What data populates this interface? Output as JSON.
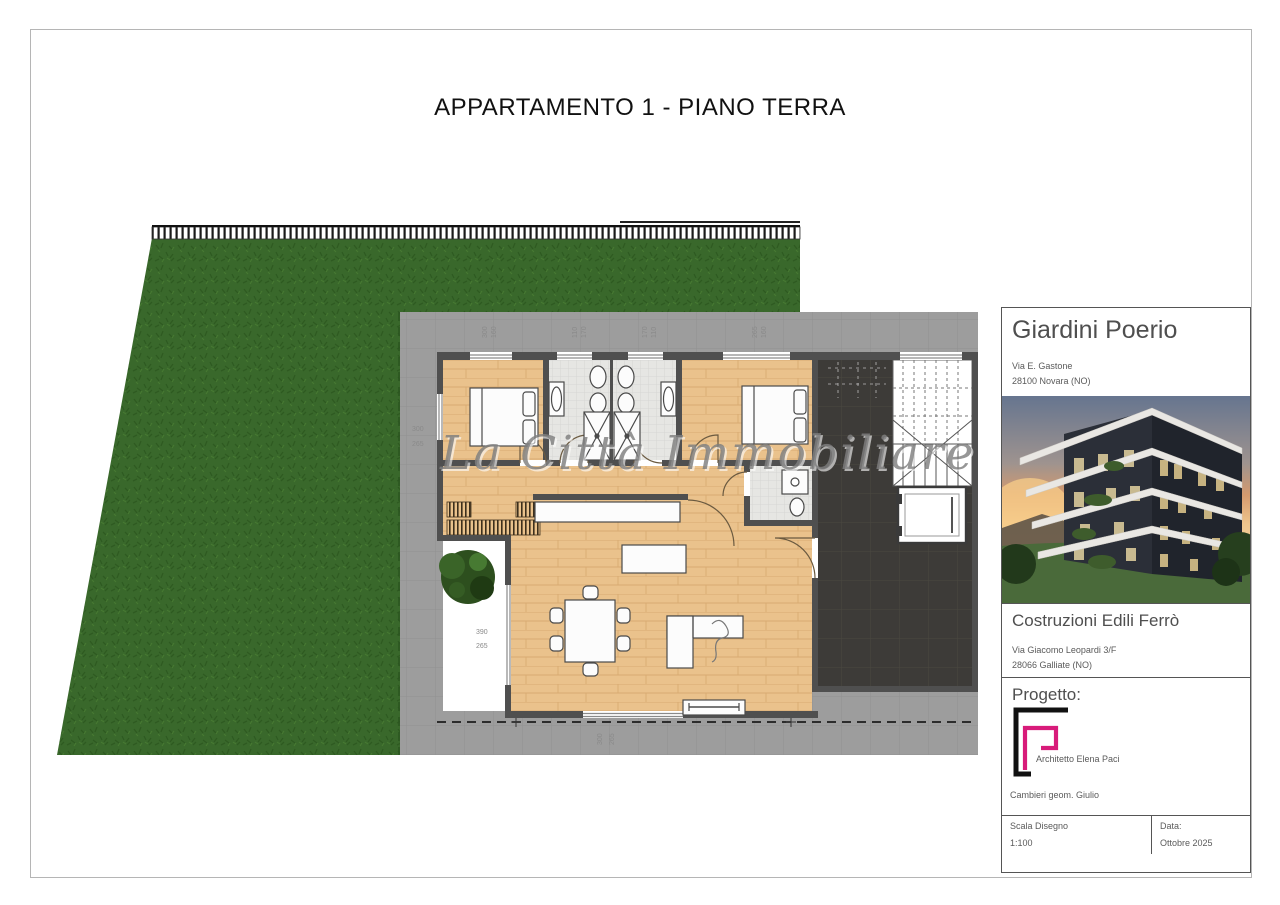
{
  "sheet": {
    "title": "APPARTAMENTO 1 - PIANO TERRA",
    "watermark": "La Città Immobiliare"
  },
  "titleblock": {
    "project_name": "Giardini Poerio",
    "project_address1": "Via E. Gastone",
    "project_address2": "28100 Novara (NO)",
    "builder_name": "Costruzioni Edili Ferrò",
    "builder_address1": "Via Giacomo Leopardi 3/F",
    "builder_address2": "28066 Galliate (NO)",
    "progetto_label": "Progetto:",
    "architect": "Architetto Elena Paci",
    "surveyor": "Cambieri geom. Giulio",
    "scale_label": "Scala Disegno",
    "scale_value": "1:100",
    "date_label": "Data:",
    "date_value": "Ottobre  2025"
  },
  "plan": {
    "dims": {
      "t1a": "300",
      "t1b": "160",
      "t2a": "110",
      "t2b": "170",
      "t3a": "170",
      "t3b": "110",
      "t4a": "265",
      "t4b": "160",
      "left_a": "300",
      "left_b": "265",
      "mid_a": "390",
      "mid_b": "265",
      "bot_a": "300",
      "bot_b": "265"
    }
  },
  "colors": {
    "accent_pink": "#d81b7a",
    "grass": "#39682b",
    "wood": "#eac28c",
    "terrace": "#9d9d9d",
    "dark_tile": "#3d3b38",
    "wall": "#4f4f4f"
  }
}
